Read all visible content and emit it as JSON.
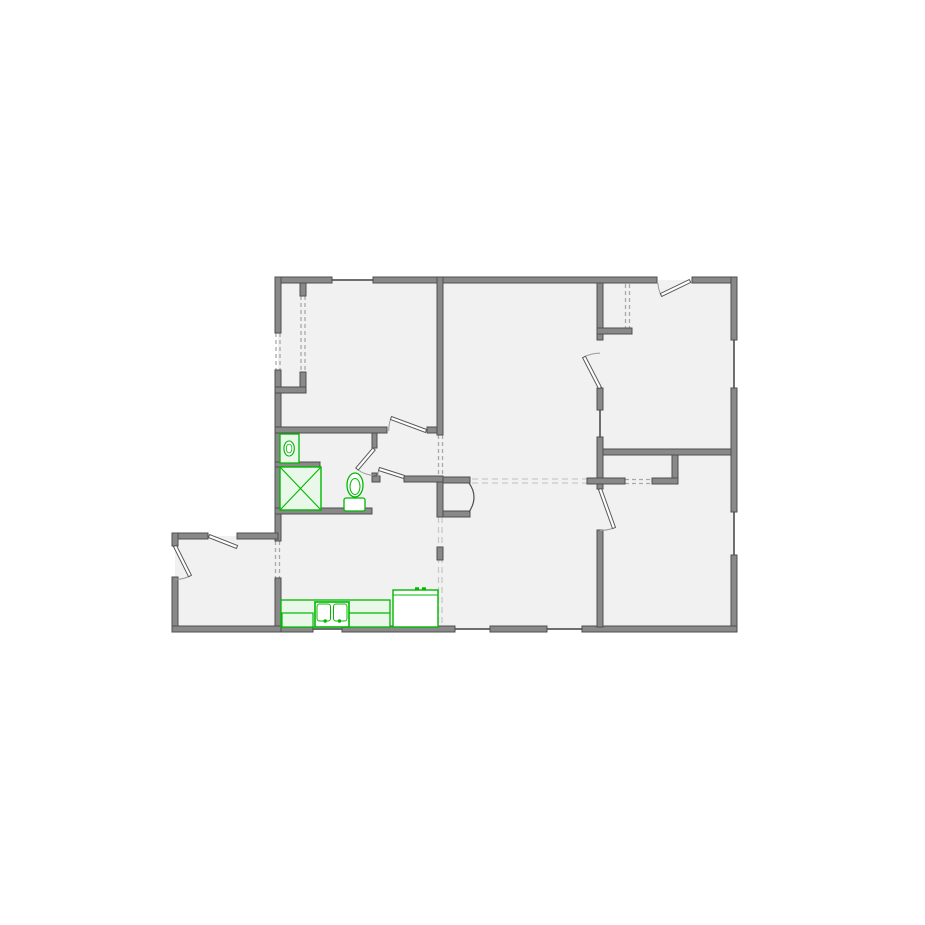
{
  "canvas": {
    "width": 925,
    "height": 925
  },
  "colors": {
    "background": "#ffffff",
    "floor": "#f1f1f1",
    "wall": "#898989",
    "wall_edge": "#4f4f4f",
    "window_line": "#6e6e6e",
    "dash": "#a9a9a9",
    "dash_light": "#c9c9c9",
    "door_fill": "#ffffff",
    "door_edge": "#5a5a5a",
    "arc": "#9a9a9a",
    "fixture": "#00b800",
    "fixture_fill": "#e9f8e9",
    "fixture_white": "#ffffff"
  },
  "floors": [
    {
      "n": "main-floor-area",
      "r": [
        278,
        280,
        456,
        349
      ]
    },
    {
      "n": "entry-extension-floor",
      "r": [
        175,
        536,
        104,
        92
      ]
    }
  ],
  "walls": [
    {
      "n": "top-wall-left",
      "r": [
        275,
        277,
        57,
        6
      ]
    },
    {
      "n": "top-wall-middle",
      "r": [
        373,
        277,
        284,
        6
      ]
    },
    {
      "n": "top-wall-right",
      "r": [
        692,
        277,
        45,
        6
      ]
    },
    {
      "n": "right-wall-upper",
      "r": [
        731,
        277,
        6,
        63
      ]
    },
    {
      "n": "right-wall-middle",
      "r": [
        731,
        388,
        6,
        124
      ]
    },
    {
      "n": "right-wall-lower",
      "r": [
        731,
        555,
        6,
        77
      ]
    },
    {
      "n": "bottom-wall-a",
      "r": [
        275,
        626,
        38,
        6
      ]
    },
    {
      "n": "bottom-wall-b",
      "r": [
        342,
        626,
        113,
        6
      ]
    },
    {
      "n": "bottom-wall-c",
      "r": [
        490,
        626,
        57,
        6
      ]
    },
    {
      "n": "bottom-wall-d",
      "r": [
        582,
        626,
        155,
        6
      ]
    },
    {
      "n": "left-wall-upper",
      "r": [
        275,
        277,
        6,
        56
      ]
    },
    {
      "n": "left-wall-middle",
      "r": [
        275,
        370,
        6,
        171
      ]
    },
    {
      "n": "left-wall-lower",
      "r": [
        275,
        578,
        6,
        54
      ]
    },
    {
      "n": "ext-top-wall-a",
      "r": [
        172,
        533,
        36,
        6
      ]
    },
    {
      "n": "ext-top-wall-b",
      "r": [
        237,
        533,
        41,
        6
      ]
    },
    {
      "n": "ext-left-wall-a",
      "r": [
        172,
        533,
        6,
        13
      ]
    },
    {
      "n": "ext-left-wall-b",
      "r": [
        172,
        577,
        6,
        55
      ]
    },
    {
      "n": "ext-bottom-wall",
      "r": [
        172,
        626,
        109,
        6
      ]
    },
    {
      "n": "closet1-jamb",
      "r": [
        300,
        283,
        6,
        13
      ]
    },
    {
      "n": "closet1-side",
      "r": [
        300,
        372,
        6,
        21
      ]
    },
    {
      "n": "closet1-bottom",
      "r": [
        275,
        387,
        31,
        6
      ]
    },
    {
      "n": "bedroom1-south-wall-a",
      "r": [
        275,
        427,
        112,
        6
      ]
    },
    {
      "n": "bedroom1-south-wall-b",
      "r": [
        427,
        427,
        16,
        6
      ]
    },
    {
      "n": "living-west-wall",
      "r": [
        437,
        277,
        6,
        158
      ]
    },
    {
      "n": "arch-column",
      "r": [
        437,
        477,
        6,
        40
      ]
    },
    {
      "n": "arch-spur-top",
      "r": [
        443,
        477,
        27,
        6
      ]
    },
    {
      "n": "arch-spur-bottom",
      "r": [
        443,
        511,
        27,
        6
      ]
    },
    {
      "n": "bath-door-jamb",
      "r": [
        372,
        433,
        5,
        15
      ]
    },
    {
      "n": "bath-door-corner",
      "r": [
        372,
        473,
        5,
        9
      ]
    },
    {
      "n": "hall-south-wall-a",
      "r": [
        372,
        476,
        8,
        6
      ]
    },
    {
      "n": "hall-south-wall-b",
      "r": [
        404,
        476,
        39,
        6
      ]
    },
    {
      "n": "bath-south-wall",
      "r": [
        275,
        508,
        97,
        6
      ]
    },
    {
      "n": "vanity-divider-wall",
      "r": [
        275,
        462,
        45,
        5
      ]
    },
    {
      "n": "center-wall-a",
      "r": [
        597,
        283,
        6,
        57
      ]
    },
    {
      "n": "closet2-bottom-wall",
      "r": [
        597,
        328,
        35,
        6
      ]
    },
    {
      "n": "center-wall-b",
      "r": [
        597,
        388,
        6,
        22
      ]
    },
    {
      "n": "center-wall-c",
      "r": [
        597,
        437,
        6,
        52
      ]
    },
    {
      "n": "center-wall-d",
      "r": [
        597,
        530,
        6,
        97
      ]
    },
    {
      "n": "hall2-north-wall",
      "r": [
        603,
        449,
        128,
        6
      ]
    },
    {
      "n": "closet3-wall-west",
      "r": [
        587,
        478,
        38,
        6
      ]
    },
    {
      "n": "closet3-wall-east",
      "r": [
        652,
        478,
        26,
        6
      ]
    },
    {
      "n": "closet3-connector",
      "r": [
        672,
        455,
        6,
        23
      ]
    },
    {
      "n": "kitchen-dash-stub",
      "r": [
        437,
        547,
        6,
        13
      ]
    }
  ],
  "windows": [
    {
      "n": "front-window",
      "s": [
        332,
        280,
        373,
        280
      ]
    },
    {
      "n": "right-window-1",
      "s": [
        734,
        340,
        734,
        388
      ]
    },
    {
      "n": "right-window-2",
      "s": [
        734,
        512,
        734,
        555
      ]
    },
    {
      "n": "rear-window-1",
      "s": [
        313,
        629,
        342,
        629
      ]
    },
    {
      "n": "rear-window-2",
      "s": [
        455,
        629,
        490,
        629
      ]
    },
    {
      "n": "rear-window-3",
      "s": [
        547,
        629,
        582,
        629
      ]
    },
    {
      "n": "interior-opening",
      "s": [
        600,
        410,
        600,
        437
      ]
    }
  ],
  "dashed": [
    {
      "n": "closet1-door-a",
      "s": [
        301,
        296,
        301,
        372
      ]
    },
    {
      "n": "closet1-door-b",
      "s": [
        305,
        296,
        305,
        372
      ]
    },
    {
      "n": "left-window-a",
      "s": [
        276,
        333,
        276,
        370
      ]
    },
    {
      "n": "left-window-b",
      "s": [
        280,
        333,
        280,
        370
      ]
    },
    {
      "n": "hall-opening-a",
      "s": [
        438.5,
        435,
        438.5,
        477
      ]
    },
    {
      "n": "hall-opening-b",
      "s": [
        442.5,
        435,
        442.5,
        477
      ]
    },
    {
      "n": "closet2-door-a",
      "s": [
        625.5,
        284,
        625.5,
        328
      ]
    },
    {
      "n": "closet2-door-b",
      "s": [
        629.5,
        284,
        629.5,
        328
      ]
    },
    {
      "n": "closet3-door-a",
      "s": [
        625,
        479.5,
        652,
        479.5
      ]
    },
    {
      "n": "closet3-door-b",
      "s": [
        625,
        483.5,
        652,
        483.5
      ]
    },
    {
      "n": "entry-opening-a",
      "s": [
        275.5,
        541,
        275.5,
        578
      ]
    },
    {
      "n": "entry-opening-b",
      "s": [
        279.5,
        541,
        279.5,
        578
      ]
    },
    {
      "n": "ceiling-break-a",
      "s": [
        472,
        479,
        588,
        479
      ],
      "light": true
    },
    {
      "n": "ceiling-break-b",
      "s": [
        472,
        483,
        588,
        483
      ],
      "light": true
    },
    {
      "n": "kitchen-break-a",
      "s": [
        438.5,
        517,
        438.5,
        626
      ],
      "light": true
    },
    {
      "n": "kitchen-break-b",
      "s": [
        442,
        517,
        442,
        626
      ],
      "light": true
    }
  ],
  "arch": {
    "n": "arched-opening",
    "path": "M469,483 Q479,497 469,512"
  },
  "doors": [
    {
      "n": "ext-north-door",
      "hinge": [
        209,
        536
      ],
      "tip": [
        237,
        547
      ],
      "jamb": null
    },
    {
      "n": "ext-west-door",
      "hinge": [
        175,
        546
      ],
      "tip": [
        190,
        576
      ],
      "jamb": [
        175,
        578
      ]
    },
    {
      "n": "bedroom1-door",
      "hinge": [
        426,
        431
      ],
      "tip": [
        391,
        418
      ],
      "jamb": [
        389,
        431
      ]
    },
    {
      "n": "bath-door",
      "hinge": [
        374,
        449
      ],
      "tip": [
        357,
        469
      ],
      "jamb": [
        374,
        474
      ]
    },
    {
      "n": "hall-kitchen-door",
      "hinge": [
        404,
        477
      ],
      "tip": [
        379,
        469
      ],
      "jamb": [
        381,
        477
      ]
    },
    {
      "n": "bedroom2-door",
      "hinge": [
        600,
        388
      ],
      "tip": [
        584,
        357
      ],
      "jamb": [
        600,
        342
      ]
    },
    {
      "n": "front-door",
      "hinge": [
        690,
        281
      ],
      "tip": [
        661,
        295
      ],
      "jamb": [
        658,
        283
      ]
    },
    {
      "n": "bedroom3-door",
      "hinge": [
        600,
        489
      ],
      "tip": [
        614,
        528
      ],
      "jamb": [
        600,
        530
      ]
    }
  ],
  "fixtures": [
    {
      "n": "bath-vanity-sink",
      "type": "vanity",
      "r": [
        280,
        434,
        19,
        29
      ]
    },
    {
      "n": "shower",
      "type": "shower",
      "r": [
        280,
        467,
        41,
        43
      ]
    },
    {
      "n": "toilet",
      "type": "toilet",
      "bowl": [
        355,
        485,
        8,
        12
      ],
      "tank": [
        344,
        498,
        21,
        13
      ]
    },
    {
      "n": "kitchen-counter",
      "type": "counter",
      "r": [
        281,
        600,
        109,
        27
      ]
    },
    {
      "n": "dishwasher",
      "type": "box",
      "r": [
        282,
        613,
        31,
        14
      ]
    },
    {
      "n": "counter-tier-line",
      "type": "line",
      "s": [
        348,
        613,
        390,
        613
      ]
    },
    {
      "n": "kitchen-sink",
      "type": "sink2",
      "r": [
        315,
        602,
        34,
        25
      ]
    },
    {
      "n": "range",
      "type": "range",
      "r": [
        393,
        590,
        45,
        37
      ]
    }
  ]
}
